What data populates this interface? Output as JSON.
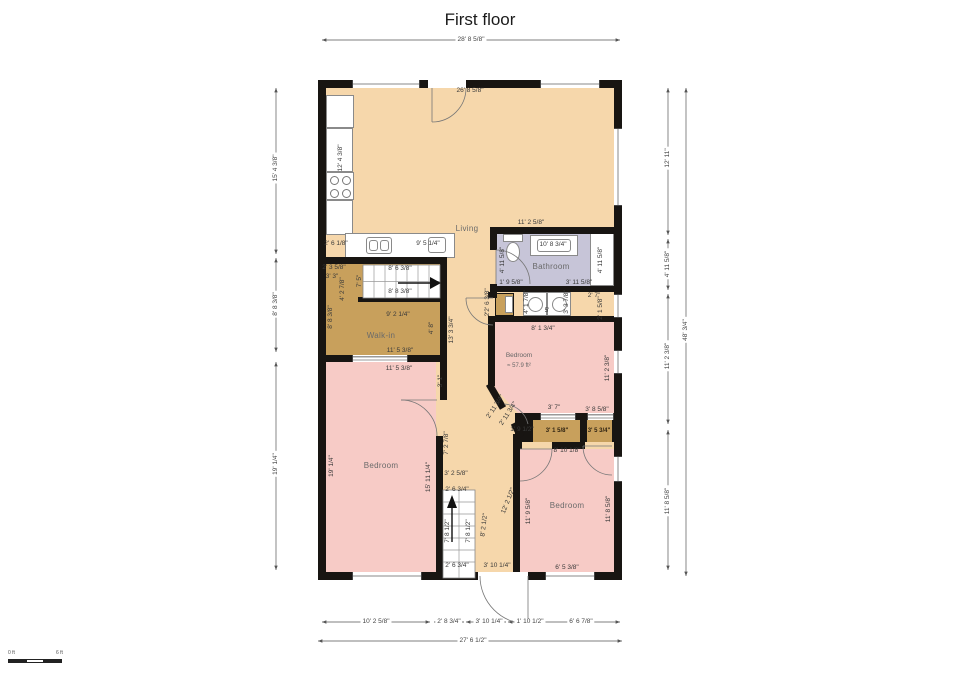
{
  "title": "First floor",
  "scale_bar": {
    "start": "0 ft",
    "end": "6 ft"
  },
  "colors": {
    "floor": "#f6d7ab",
    "bedroom": "#f7cbc6",
    "closet": "#c8a05c",
    "bathroom": "#c7c5d8",
    "wall": "#181512",
    "dimline": "#555555"
  },
  "rooms": [
    "Living",
    "Bathroom",
    "Walk-in",
    "Bedroom",
    "Bedroom",
    "Bedroom"
  ],
  "labels": [
    {
      "t": "28' 8 5/8\"",
      "x": 471,
      "y": 40,
      "c": "ext"
    },
    {
      "t": "15' 4 3/8\"",
      "x": 276,
      "y": 168,
      "r": -90,
      "c": "ext"
    },
    {
      "t": "8' 8 3/8\"",
      "x": 276,
      "y": 304,
      "r": -90,
      "c": "ext"
    },
    {
      "t": "19' 1/4\"",
      "x": 276,
      "y": 464,
      "r": -90,
      "c": "ext"
    },
    {
      "t": "12' 11\"",
      "x": 668,
      "y": 158,
      "r": -90,
      "c": "ext"
    },
    {
      "t": "4' 11 5/8\"",
      "x": 668,
      "y": 264,
      "r": -90,
      "c": "ext"
    },
    {
      "t": "11' 2 3/8\"",
      "x": 668,
      "y": 356,
      "r": -90,
      "c": "ext"
    },
    {
      "t": "11' 8 5/8\"",
      "x": 668,
      "y": 501,
      "r": -90,
      "c": "ext"
    },
    {
      "t": "48' 3/4\"",
      "x": 686,
      "y": 330,
      "r": -90,
      "c": "ext"
    },
    {
      "t": "10' 2 5/8\"",
      "x": 376,
      "y": 622,
      "c": "ext"
    },
    {
      "t": "2' 8 3/4\"",
      "x": 449,
      "y": 622,
      "c": "ext"
    },
    {
      "t": "3' 10 1/4\"",
      "x": 489,
      "y": 622,
      "c": "ext"
    },
    {
      "t": "1' 10 1/2\"",
      "x": 530,
      "y": 622,
      "c": "ext"
    },
    {
      "t": "6' 6 7/8\"",
      "x": 581,
      "y": 622,
      "c": "ext"
    },
    {
      "t": "27' 6 1/2\"",
      "x": 473,
      "y": 641,
      "c": "ext"
    },
    {
      "t": "26' 8 5/8\"",
      "x": 470,
      "y": 91
    },
    {
      "t": "12' 4 3/8\"",
      "x": 341,
      "y": 158,
      "r": -90
    },
    {
      "t": "2' 6 1/8\"",
      "x": 336,
      "y": 244
    },
    {
      "t": "9' 5 1/4\"",
      "x": 428,
      "y": 244
    },
    {
      "t": "11' 2 5/8\"",
      "x": 531,
      "y": 223
    },
    {
      "t": "10' 8 3/4\"",
      "x": 553,
      "y": 245
    },
    {
      "t": "4' 11 5/8\"",
      "x": 503,
      "y": 260,
      "r": -90
    },
    {
      "t": "4' 11 5/8\"",
      "x": 601,
      "y": 260,
      "r": -90
    },
    {
      "t": "1' 9 5/8\"",
      "x": 511,
      "y": 283
    },
    {
      "t": "3' 11 5/8\"",
      "x": 579,
      "y": 283
    },
    {
      "t": "2' 3 5/8\"",
      "x": 334,
      "y": 268
    },
    {
      "t": "3' 3\"",
      "x": 332,
      "y": 277
    },
    {
      "t": "4' 2 7/8\"",
      "x": 343,
      "y": 289,
      "r": -90
    },
    {
      "t": "8' 8 3/8\"",
      "x": 331,
      "y": 317,
      "r": -90
    },
    {
      "t": "7' 5\"",
      "x": 360,
      "y": 281,
      "r": -90
    },
    {
      "t": "8' 6 3/8\"",
      "x": 400,
      "y": 269
    },
    {
      "t": "8' 8 3/8\"",
      "x": 400,
      "y": 292
    },
    {
      "t": "9' 2 1/4\"",
      "x": 398,
      "y": 315
    },
    {
      "t": "4' 8\"",
      "x": 432,
      "y": 328,
      "r": -90
    },
    {
      "t": "13' 3 3/4\"",
      "x": 452,
      "y": 330,
      "r": -90
    },
    {
      "t": "11' 5 3/8\"",
      "x": 400,
      "y": 351
    },
    {
      "t": "11' 5 3/8\"",
      "x": 399,
      "y": 369
    },
    {
      "t": "3' 1\"",
      "x": 441,
      "y": 381,
      "r": -90
    },
    {
      "t": "19' 1/4\"",
      "x": 332,
      "y": 466,
      "r": -90
    },
    {
      "t": "15' 11 1/4\"",
      "x": 429,
      "y": 477,
      "r": -90
    },
    {
      "t": "7' 2 7/8\"",
      "x": 447,
      "y": 443,
      "r": -90
    },
    {
      "t": "2' 6 3/8\"",
      "x": 488,
      "y": 300,
      "r": -90
    },
    {
      "t": "2'",
      "x": 488,
      "y": 314,
      "r": -90
    },
    {
      "t": "4' 1 7/8\"",
      "x": 527,
      "y": 302,
      "r": -90
    },
    {
      "t": "3' 3 7/8\"",
      "x": 567,
      "y": 302,
      "r": -90
    },
    {
      "t": "5'",
      "x": 547,
      "y": 311
    },
    {
      "t": "2' 7\"",
      "x": 594,
      "y": 296
    },
    {
      "t": "2' 1 5/8\"",
      "x": 601,
      "y": 308,
      "r": -90
    },
    {
      "t": "8' 1 3/4\"",
      "x": 543,
      "y": 329
    },
    {
      "t": "11' 2 3/8\"",
      "x": 608,
      "y": 368,
      "r": -90
    },
    {
      "t": "2' 11 3/4\"",
      "x": 496,
      "y": 407,
      "r": -57
    },
    {
      "t": "2' 11 3/4\"",
      "x": 509,
      "y": 414,
      "r": -57
    },
    {
      "t": "3' 7\"",
      "x": 554,
      "y": 408
    },
    {
      "t": "3' 8 5/8\"",
      "x": 597,
      "y": 410
    },
    {
      "t": "1' 9 1/2\"",
      "x": 522,
      "y": 430
    },
    {
      "t": "3' 1 5/8\"",
      "x": 557,
      "y": 431,
      "c": "closet"
    },
    {
      "t": "3' 5 3/4\"",
      "x": 599,
      "y": 431,
      "c": "closet"
    },
    {
      "t": "8' 10 1/8\"",
      "x": 567,
      "y": 451
    },
    {
      "t": "11' 9 5/8\"",
      "x": 529,
      "y": 511,
      "r": -90
    },
    {
      "t": "11' 8 5/8\"",
      "x": 609,
      "y": 509,
      "r": -90
    },
    {
      "t": "6' 5 3/8\"",
      "x": 567,
      "y": 568
    },
    {
      "t": "3' 2 5/8\"",
      "x": 456,
      "y": 474
    },
    {
      "t": "2' 6 3/4\"",
      "x": 457,
      "y": 490
    },
    {
      "t": "7' 8 1/2\"",
      "x": 448,
      "y": 531,
      "r": -90
    },
    {
      "t": "7' 8 1/2\"",
      "x": 469,
      "y": 531,
      "r": -90
    },
    {
      "t": "2' 6 3/4\"",
      "x": 457,
      "y": 566
    },
    {
      "t": "3' 10 1/4\"",
      "x": 497,
      "y": 566
    },
    {
      "t": "8' 2 1/2\"",
      "x": 485,
      "y": 525,
      "r": -83
    },
    {
      "t": "12' 2 1/2\"",
      "x": 509,
      "y": 501,
      "r": -68
    },
    {
      "t": "Living",
      "x": 467,
      "y": 229,
      "c": "room"
    },
    {
      "t": "Bathroom",
      "x": 551,
      "y": 267,
      "c": "room"
    },
    {
      "t": "Walk-in",
      "x": 381,
      "y": 336,
      "c": "room"
    },
    {
      "t": "Bedroom",
      "x": 381,
      "y": 466,
      "c": "room"
    },
    {
      "t": "Bedroom",
      "x": 567,
      "y": 506,
      "c": "room"
    },
    {
      "t": "Bedroom",
      "x": 519,
      "y": 356,
      "c": "mid"
    },
    {
      "t": "≈ 57.9 ft²",
      "x": 519,
      "y": 366,
      "c": "area"
    }
  ]
}
